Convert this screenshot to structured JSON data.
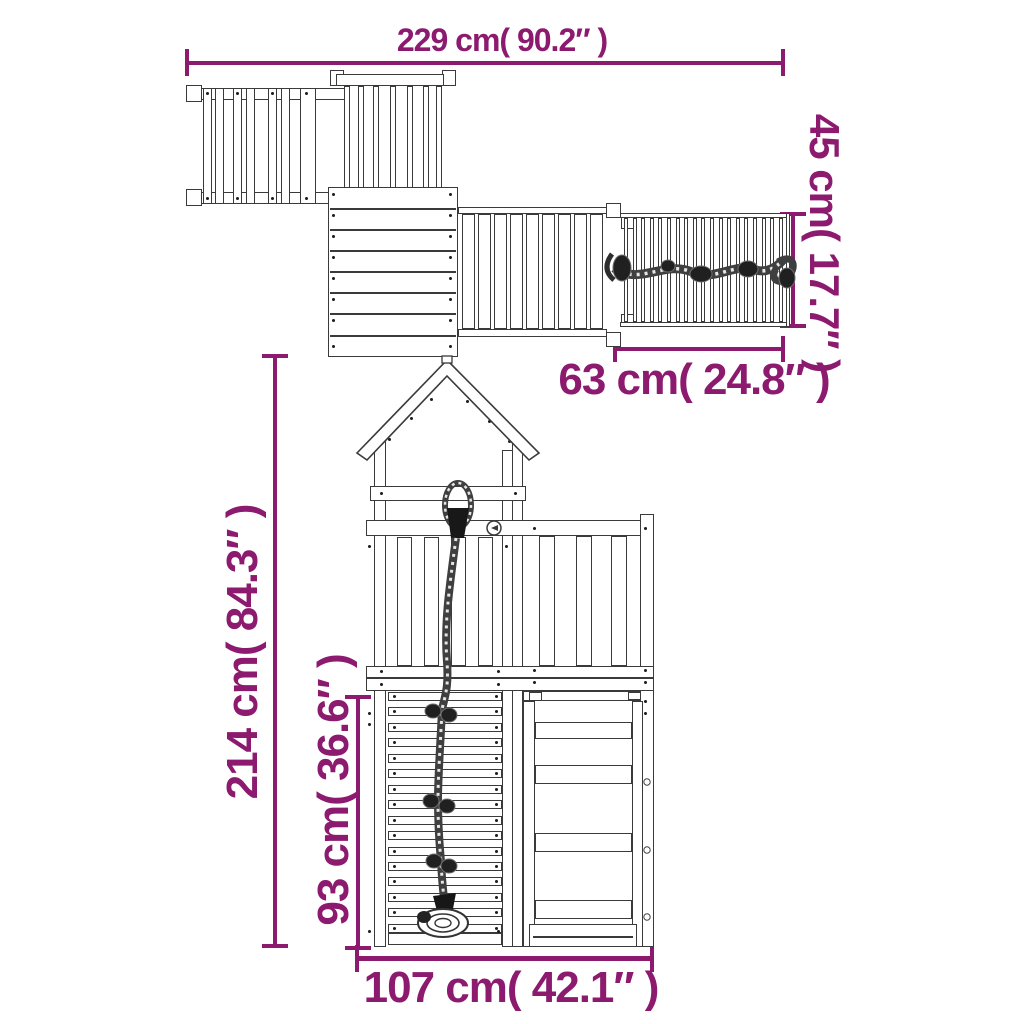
{
  "colors": {
    "dimension_text": "#8C1A6E",
    "structure_line": "#3A3A3A"
  },
  "plan_view": {
    "overall_width_label": "229 cm( 90.2″ )",
    "ramp_length_label": "63 cm( 24.8″ )",
    "ramp_width_label": "45 cm( 17.7″ )"
  },
  "front_view": {
    "overall_height_label": "214 cm( 84.3″ )",
    "climbing_wall_height_label": "93 cm( 36.6″ )",
    "base_width_label": "107 cm( 42.1″ )"
  }
}
